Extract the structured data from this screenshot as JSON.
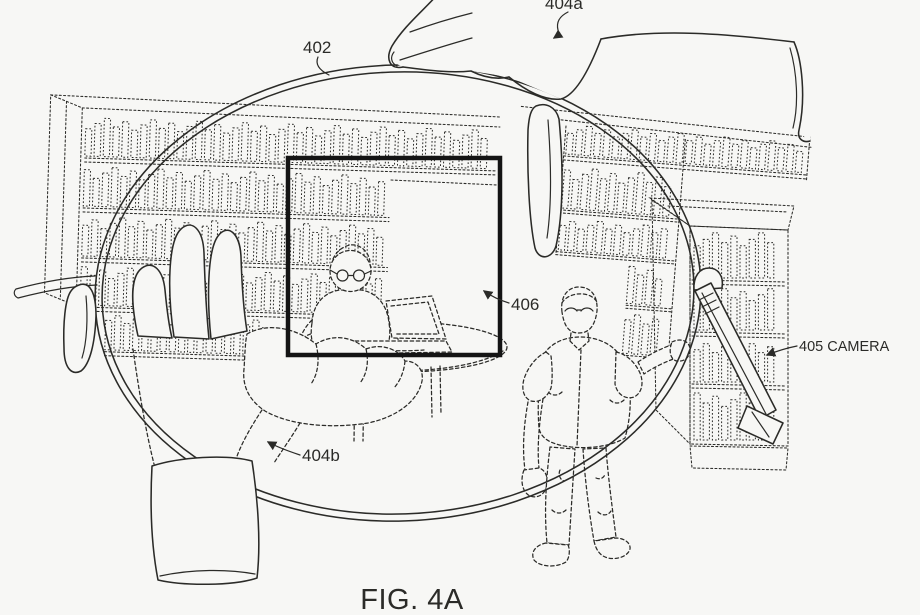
{
  "figure": {
    "caption": "FIG. 4A",
    "labels": {
      "lens": "402",
      "top_hand": "404a",
      "inset_box": "406",
      "bottom_hand": "404b",
      "camera": "405 CAMERA"
    }
  },
  "colors": {
    "background": "#f7f7f5",
    "ink": "#2b2b28",
    "box_stroke": "#141414"
  }
}
